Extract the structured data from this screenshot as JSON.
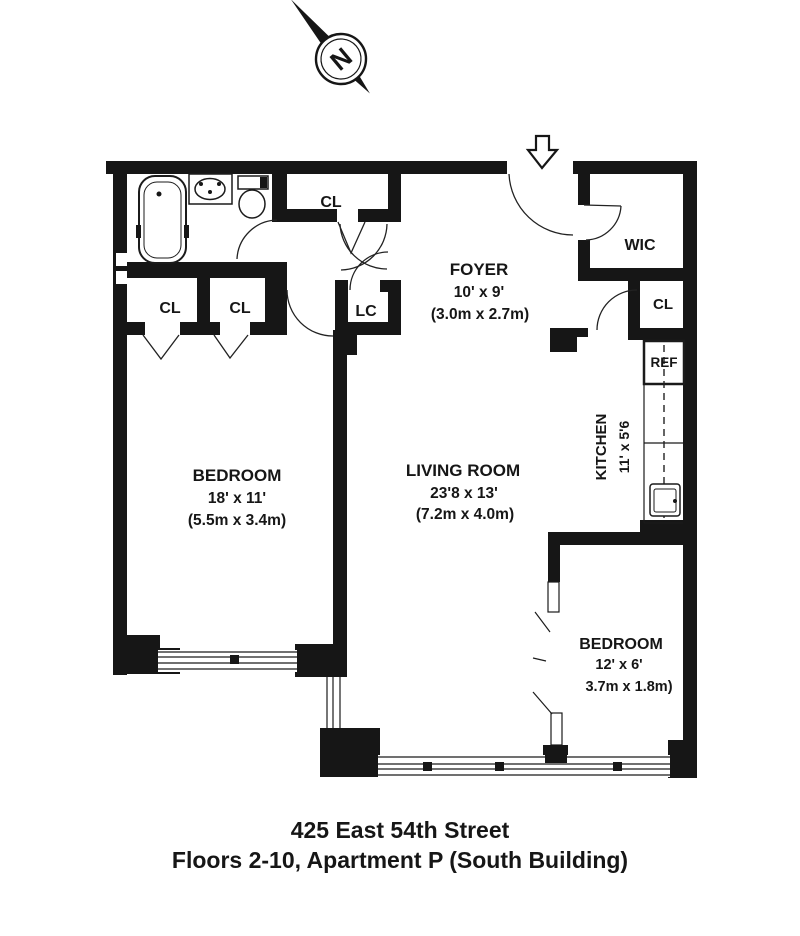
{
  "compass": {
    "north_label": "N"
  },
  "rooms": {
    "foyer": {
      "name": "FOYER",
      "dim_ft": "10' x 9'",
      "dim_m": "(3.0m x 2.7m)"
    },
    "living_room": {
      "name": "LIVING ROOM",
      "dim_ft": "23'8 x 13'",
      "dim_m": "(7.2m x 4.0m)"
    },
    "bedroom_left": {
      "name": "BEDROOM",
      "dim_ft": "18' x 11'",
      "dim_m": "(5.5m x 3.4m)"
    },
    "bedroom_right": {
      "name": "BEDROOM",
      "dim_ft": "12' x 6'",
      "dim_m": "3.7m x 1.8m)"
    },
    "kitchen": {
      "name": "KITCHEN",
      "dim_ft": "11' x 5'6"
    },
    "wic": {
      "name": "WIC"
    },
    "linen_closet": {
      "name": "LC"
    },
    "closet_hall": {
      "name": "CL"
    },
    "closet_bedroom_left": {
      "name": "CL"
    },
    "closet_bedroom_right": {
      "name": "CL"
    },
    "closet_wic": {
      "name": "CL"
    },
    "refrigerator_label": "REF"
  },
  "caption": {
    "line1": "425 East 54th Street",
    "line2": "Floors 2-10, Apartment P (South Building)"
  },
  "colors": {
    "wall": "#161616",
    "line": "#222222",
    "background": "#ffffff",
    "text": "#161616"
  }
}
